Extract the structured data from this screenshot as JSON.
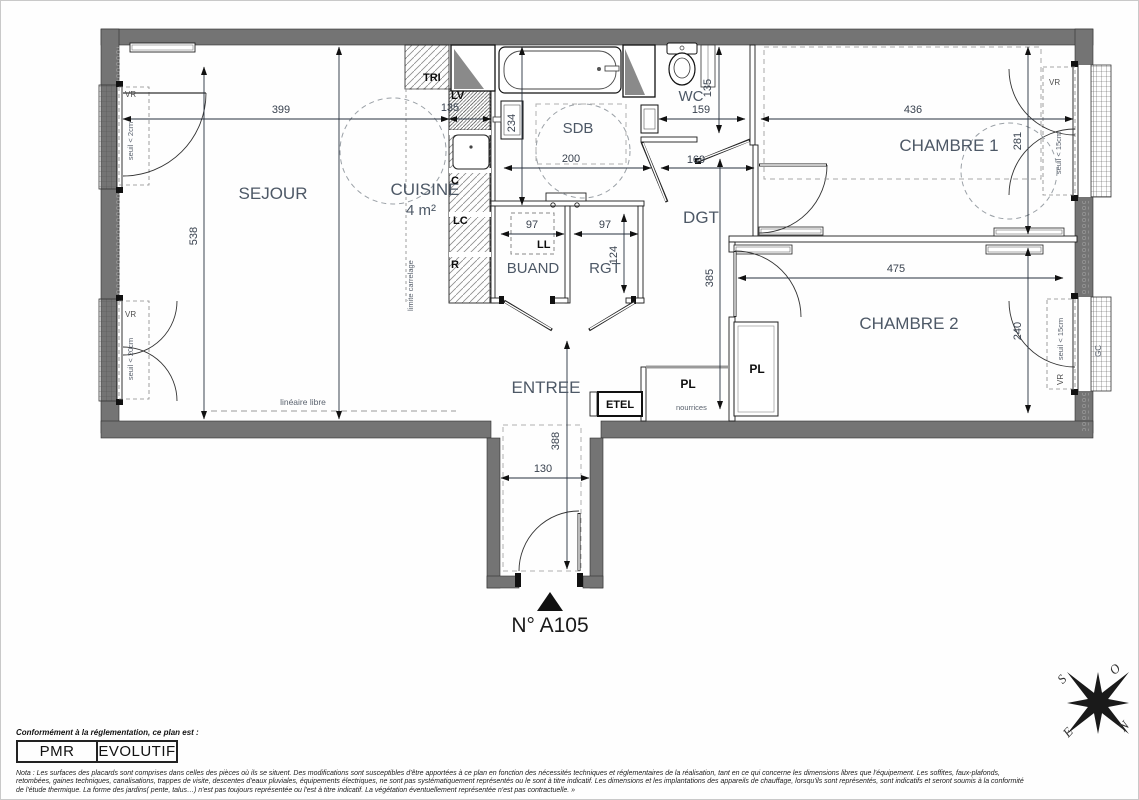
{
  "plan": {
    "unit_number": "N° A105",
    "rooms": {
      "sejour": "SEJOUR",
      "cuisine": "CUISINE",
      "cuisine_area": "4 m²",
      "sdb": "SDB",
      "wc": "WC",
      "dgt": "DGT",
      "buand": "BUAND",
      "rgt": "RGT",
      "entree": "ENTREE",
      "chambre1": "CHAMBRE 1",
      "chambre2": "CHAMBRE 2",
      "placard": "PL",
      "etel": "ETEL"
    },
    "equipment": {
      "tri": "TRI",
      "lv": "LV",
      "c": "C",
      "lc": "LC",
      "r": "R",
      "ll": "LL"
    },
    "annotations": {
      "limite_carrelage": "limite carrelage",
      "lineaire_libre": "linéaire libre",
      "nourrices": "nourrices",
      "gc": "GC",
      "vr": "VR",
      "seuil_2cm": "seuil < 2cm",
      "seuil_20cm": "seuil < 20cm",
      "seuil_15cm": "seuil < 15cm"
    },
    "dimensions": {
      "sejour_w": "399",
      "cuisine_w": "135",
      "sejour_h": "538",
      "sdb_h": "234",
      "sdb_w": "200",
      "wc_w": "159",
      "wc_h": "135",
      "dgt_door": "169",
      "ch1_w": "436",
      "ch1_h": "281",
      "ch2_w": "475",
      "ch2_h": "240",
      "buand_w": "97",
      "rgt_w": "97",
      "rgt_h": "124",
      "dgt_h": "385",
      "entree_h": "388",
      "entree_w": "130"
    },
    "compass": {
      "n": "N",
      "s": "S",
      "e": "E",
      "o": "O"
    }
  },
  "footer": {
    "caption": "Conformément à la réglementation, ce plan est :",
    "badge_pmr": "PMR",
    "badge_evolutif": "EVOLUTIF",
    "nota_line1": "Nota : Les surfaces des placards sont comprises dans celles des pièces où ils se situent. Des modifications sont susceptibles d'être apportées à ce plan en fonction des nécessités techniques et réglementaires de la réalisation, tant en ce qui concerne les dimensions libres que l'équipement.  Les soffites, faux-plafonds,",
    "nota_line2": "retombées, gaines techniques, canalisations, trappes de visite, descentes d'eaux pluviales, équipements électriques, ne sont pas systématiquement représentés ou le sont à titre indicatif. Les dimensions et les implantations des appareils de chauffage, lorsqu'ils sont représentés, sont indicatifs et seront soumis à la conformité",
    "nota_line3": "de l'étude thermique. La forme des jardins( pente, talus…) n'est pas toujours représentée ou l'est à titre indicatif. La végétation éventuellement représentée n'est pas contractuelle. »"
  }
}
